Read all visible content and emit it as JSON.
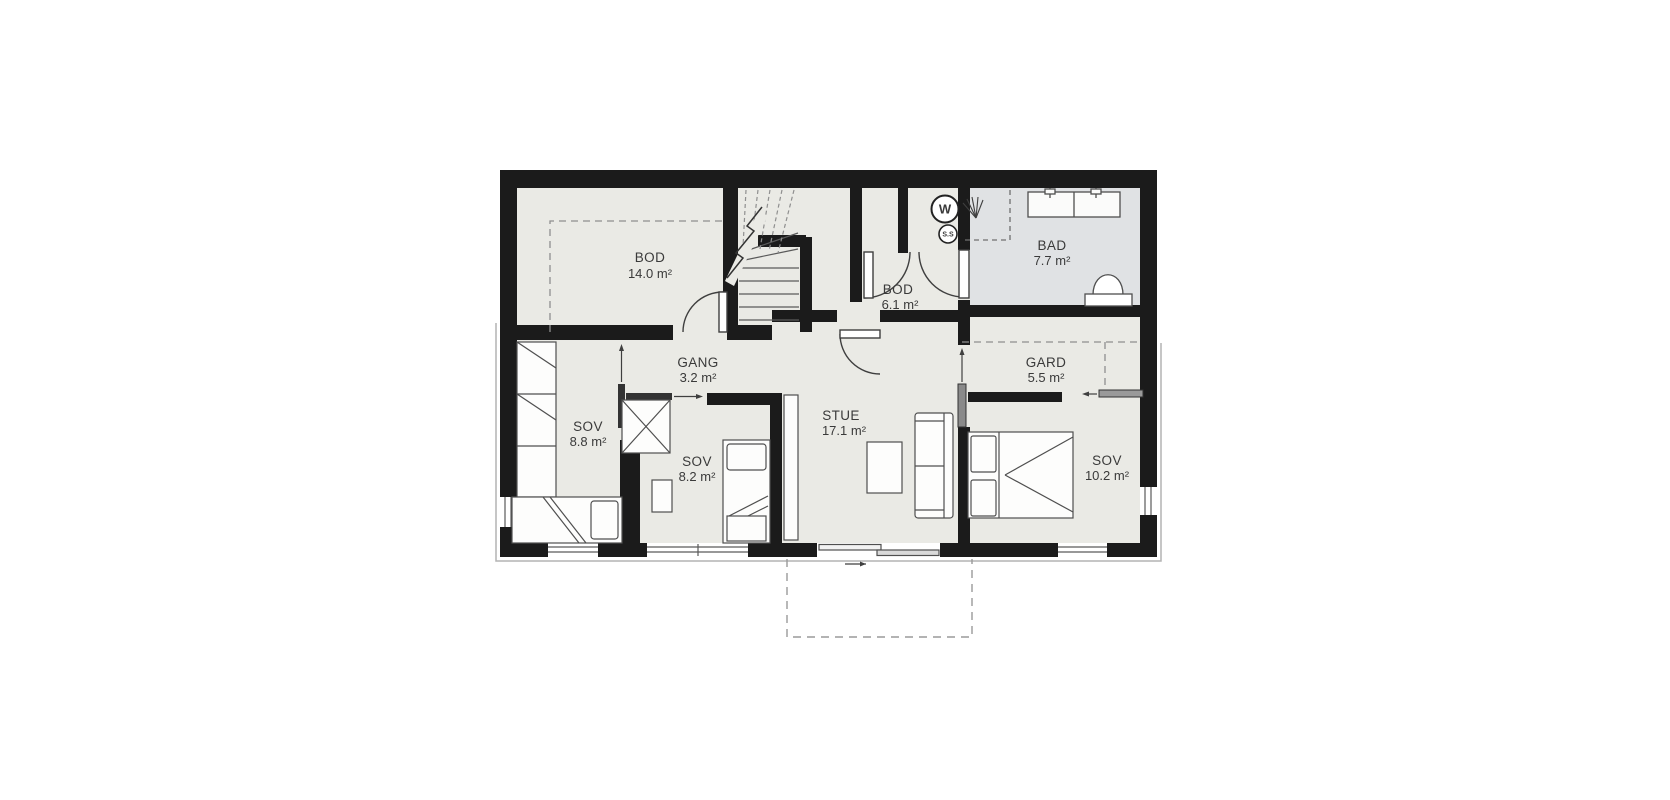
{
  "plan": {
    "type": "floor-plan",
    "rooms": [
      {
        "id": "bod14",
        "name": "BOD",
        "area": "14.0 m²"
      },
      {
        "id": "bod61",
        "name": "BOD",
        "area": "6.1 m²"
      },
      {
        "id": "bad",
        "name": "BAD",
        "area": "7.7 m²"
      },
      {
        "id": "gang",
        "name": "GANG",
        "area": "3.2 m²"
      },
      {
        "id": "gard",
        "name": "GARD",
        "area": "5.5 m²"
      },
      {
        "id": "sov88",
        "name": "SOV",
        "area": "8.8 m²"
      },
      {
        "id": "sov82",
        "name": "SOV",
        "area": "8.2 m²"
      },
      {
        "id": "stue",
        "name": "STUE",
        "area": "17.1 m²"
      },
      {
        "id": "sov102",
        "name": "SOV",
        "area": "10.2 m²"
      }
    ],
    "symbols": [
      {
        "id": "washer",
        "label": "W"
      },
      {
        "id": "ss",
        "label": "S.S"
      }
    ],
    "colors": {
      "wall": "#1b1b1b",
      "floor": "#eaeae5",
      "bathroom_floor": "#e0e2e4",
      "furniture_stroke": "#4f4f4f",
      "dash": "#8f8f8f",
      "text": "#3a3a3a"
    }
  }
}
